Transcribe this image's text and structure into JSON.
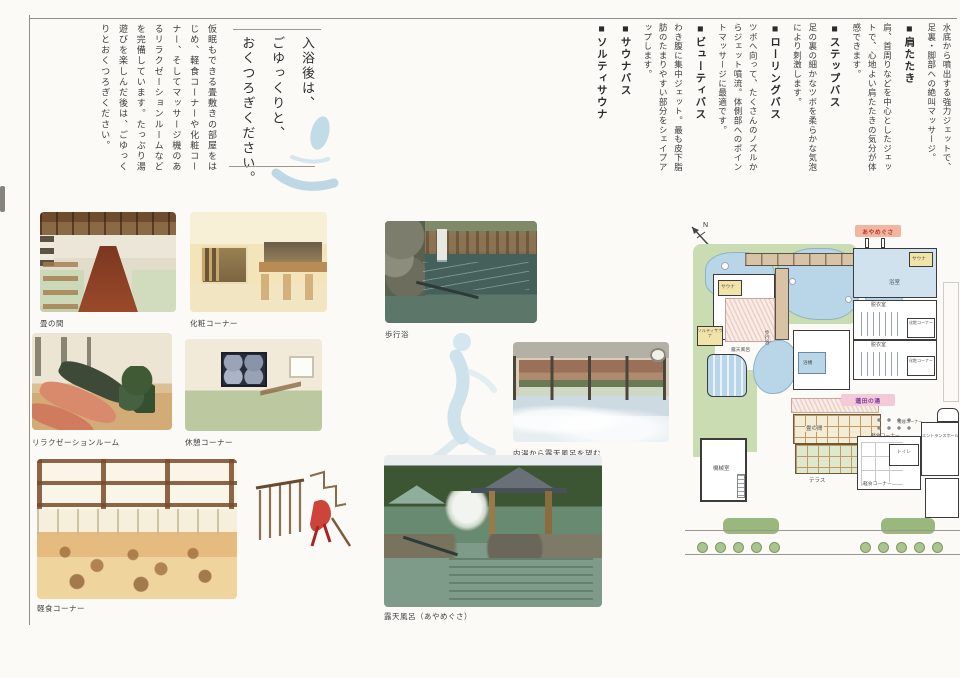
{
  "intro": {
    "title_lines": [
      "入浴後は、",
      "ごゆっくりと、",
      "おくつろぎください。"
    ],
    "body": "仮眠もできる畳敷きの部屋をはじめ、軽食コーナーや化粧コーナー、そしてマッサージ機のあるリラクゼーションルームなどを完備しています。たっぷり湯遊びを楽しんだ後は、ごゆっくりとおくつろぎください。"
  },
  "baths": {
    "lead": "水底から噴出する強力ジェットで、足裏・脚部への絶叫マッサージ。",
    "sections": [
      {
        "heading": "■肩たたき",
        "body": "肩、首周りなどを中心としたジェットで、心地よい肩たたきの気分が体感できます。"
      },
      {
        "heading": "■ステップバス",
        "body": "足の裏の細かなツボを柔らかな気泡により刺激します。"
      },
      {
        "heading": "■ローリングバス",
        "body": "ツボへ向って、たくさんのノズルからジェット噴流。体側部へのポイントマッサージに最適です。"
      },
      {
        "heading": "■ビューティバス",
        "body": "わき腹に集中ジェット。最も皮下脂肪のたまりやすい部分をシェイプアップします。"
      },
      {
        "heading": "■サウナバス",
        "body": ""
      },
      {
        "heading": "■ソルティサウナ",
        "body": ""
      }
    ]
  },
  "photos": [
    {
      "caption": "畳の間"
    },
    {
      "caption": "化粧コーナー"
    },
    {
      "caption": "リラクゼーションルーム"
    },
    {
      "caption": "休憩コーナー"
    },
    {
      "caption": "軽食コーナー"
    },
    {
      "caption": "歩行浴"
    },
    {
      "caption": "内湯から露天風呂を望む"
    },
    {
      "caption": "露天風呂（あやめぐさ）"
    }
  ],
  "map": {
    "north_label": "N",
    "badges": {
      "ayamegusa": "あやめぐさ",
      "hasuda_no_yu": "蓮田の湯"
    },
    "rooms": [
      {
        "label": "浴室"
      },
      {
        "label": "サウナ"
      },
      {
        "label": "ソルティサウナ"
      },
      {
        "label": "脱衣室"
      },
      {
        "label": "化粧コーナー"
      },
      {
        "label": "脱衣室"
      },
      {
        "label": "化粧コーナー"
      },
      {
        "label": "サウナ"
      },
      {
        "label": "ソルティサウナ"
      },
      {
        "label": "露天風呂"
      },
      {
        "label": "歩行浴"
      },
      {
        "label": "浴槽"
      },
      {
        "label": "機械室"
      },
      {
        "label": "畳の間"
      },
      {
        "label": "テラス"
      },
      {
        "label": "軽食コーナー"
      },
      {
        "label": "喫煙コーナー"
      },
      {
        "label": "軽食コーナー"
      },
      {
        "label": "トイレ"
      },
      {
        "label": "エントランスホール"
      }
    ],
    "colors": {
      "garden": "#c9dcb2",
      "pond": "#b9d6e8",
      "bath_room": "#cfe2ee",
      "sauna_room": "#f2e4a8",
      "corridor": "#d8c3a6",
      "badge_ayamegusa_bg": "#f2b5a0",
      "badge_ayamegusa_text": "#b83a28",
      "badge_hasuda_bg": "#f4c9d8",
      "badge_hasuda_text": "#7a3a9a",
      "watercolor_blue": "#b9d4e4"
    }
  }
}
